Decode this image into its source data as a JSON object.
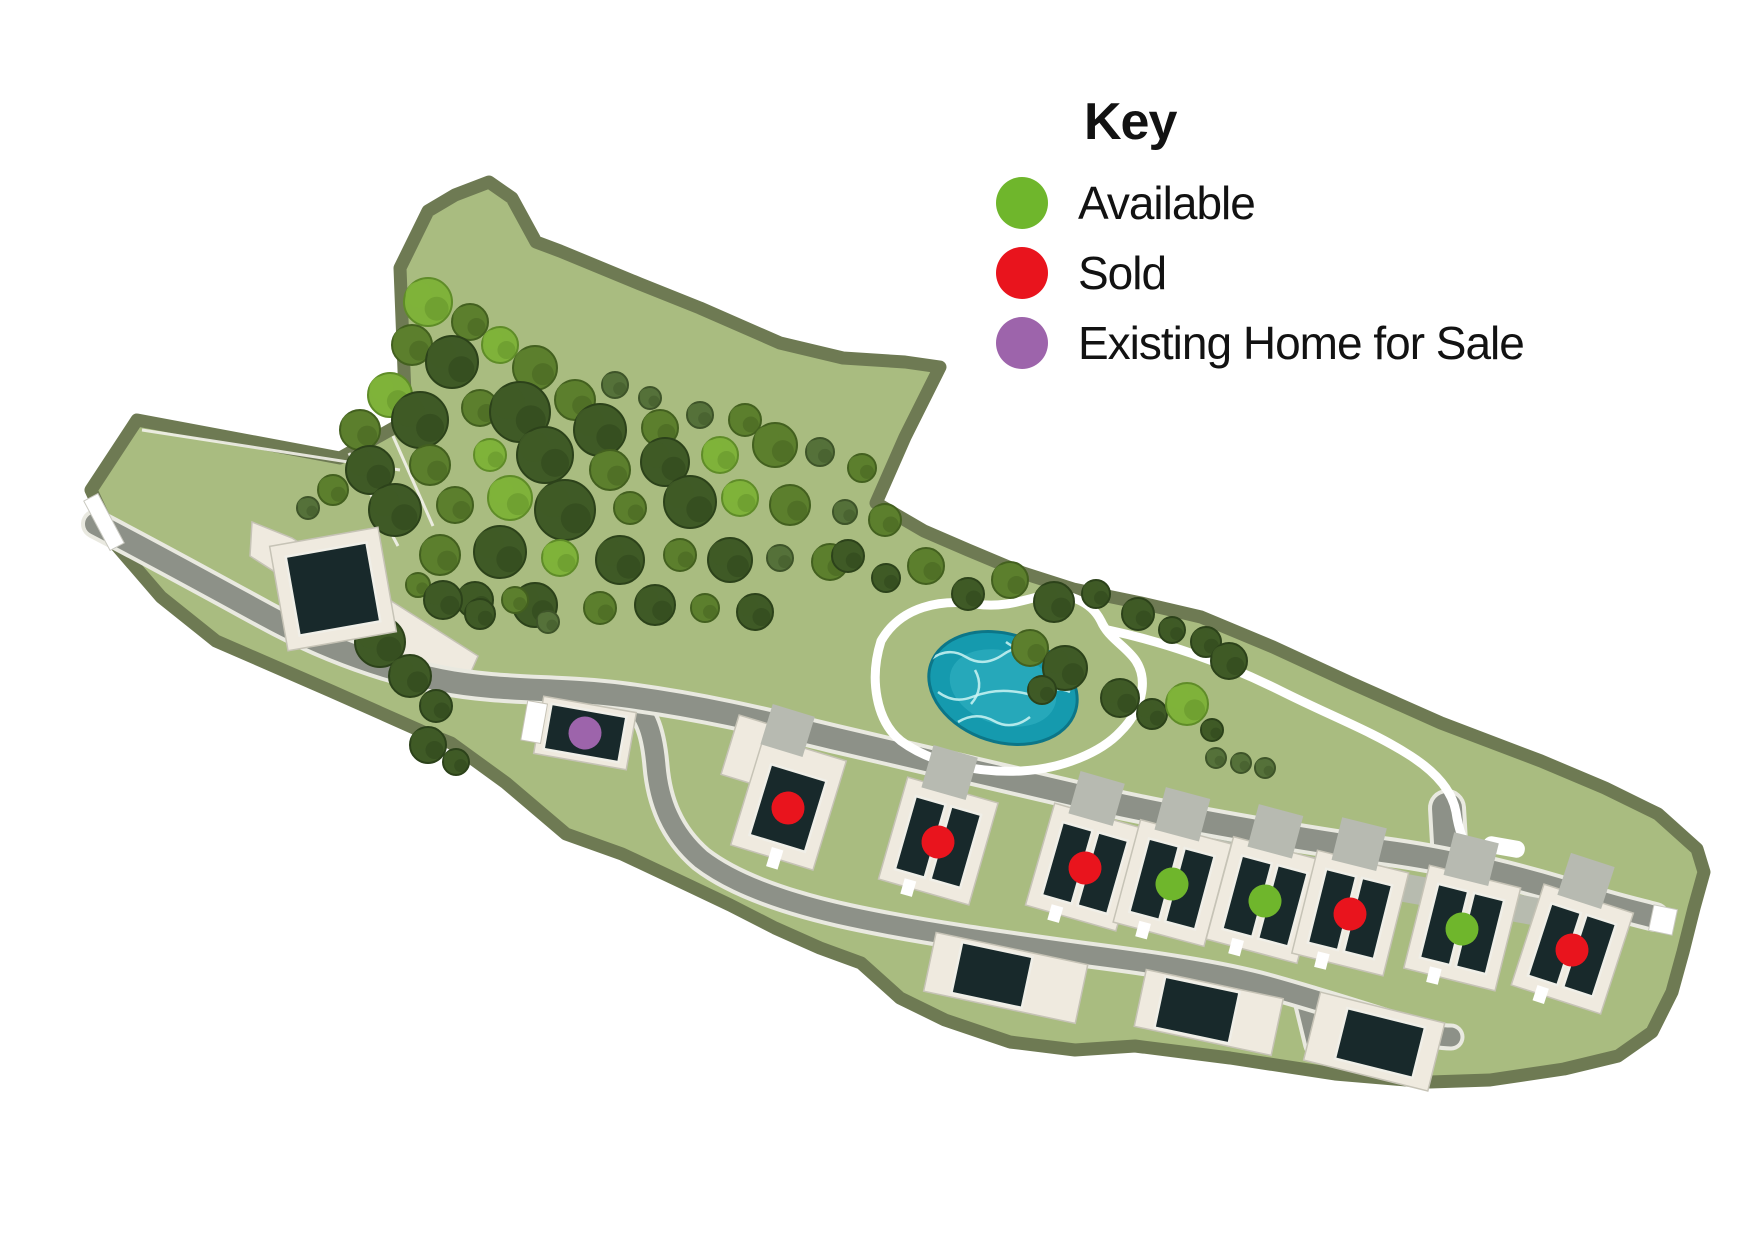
{
  "legend": {
    "title": "Key",
    "items": [
      {
        "label": "Available",
        "color": "#6fb62c",
        "status": "available"
      },
      {
        "label": "Sold",
        "color": "#e9141d",
        "status": "sold"
      },
      {
        "label": "Existing Home for Sale",
        "color": "#9d64ab",
        "status": "existing"
      }
    ]
  },
  "map": {
    "colors": {
      "site": "#a9bc80",
      "border": "#6e7a53",
      "road": "#8d9188",
      "roadEdge": "#e9e9e0",
      "apron": "#b7bab1",
      "pad": "#efeadf",
      "padStroke": "#c6c3b6",
      "building": "#18292b",
      "buildingStroke": "#f0efe8",
      "pathWhite": "#ffffff",
      "pondFill": "#159aae",
      "pondEdge": "#0c7688",
      "pondLight": "#49c4d2",
      "crackle": "#cdf4f3",
      "fieldLine": "#f2f1ea",
      "treeD": "#3f5a26",
      "treeM": "#5c7f2d",
      "treeL": "#7fb23a",
      "treeB": "#55713a",
      "treeStrokeD": "#2c421a",
      "treeStrokeM": "#43601f",
      "treeStrokeL": "#5f8c28",
      "treeStrokeB": "#3e5429"
    },
    "boundary": "M137,420 L340,458 L406,421 L400,268 L428,211 L455,195 L489,182 L512,198 L536,242 L560,251 L640,284 L700,308 L780,343 L843,358 L905,362 L940,367 L905,437 L876,503 L924,531 L968,550 L1023,573 L1073,589 L1141,603 L1201,617 L1273,647 L1351,683 L1441,723 L1541,761 L1605,788 L1658,814 L1697,849 L1704,872 L1694,908 L1683,952 L1672,992 L1652,1032 L1618,1056 L1564,1069 L1490,1080 L1430,1082 L1335,1074 L1230,1058 L1135,1046 L1075,1050 L1010,1042 L945,1020 L900,998 L861,963 L820,948 L775,928 L730,905 L690,886 L622,854 L566,834 L506,783 L451,743 L421,731 L331,691 L216,641 L161,597 L117,546 L91,490 Z",
    "fieldLines": [
      "M142,430 L400,470",
      "M393,436 L433,526",
      "M349,453 L398,546"
    ],
    "creamDrive": "252,522 292,538 478,656 462,692 250,556",
    "band": "1146,826 1560,902 1560,930 1146,856",
    "roads": {
      "hammer": {
        "d": "M1447,808 L1450,860",
        "w": 30
      },
      "stubC": {
        "d": "M1310,1002 L1320,1043",
        "w": 26
      },
      "loop": {
        "d": "M622,696 C646,708 653,731 656,766 C659,801 671,833 701,859 C736,886 791,904 851,917 C921,932 1001,943 1081,954 C1151,963 1221,973 1271,987 C1321,1001 1371,1017 1409,1029 C1429,1035 1443,1037 1451,1037",
        "w": 19
      },
      "main": {
        "d": "M96,524 C150,552 210,585 265,615 C320,645 380,668 440,680 C500,692 560,688 622,696 C700,706 762,721 832,738 C902,755 1002,778 1102,801 C1202,823 1302,839 1382,851 C1452,860 1532,880 1592,900 C1622,909 1640,913 1655,917",
        "w": 22
      }
    },
    "paths": {
      "pondLoop": "M881,641 C901,606 941,599 976,604 C1001,608 1021,601 1041,596 C1066,591 1091,601 1101,621 C1109,639 1126,646 1136,661 C1149,681 1141,711 1121,731 C1101,753 1061,769 1021,771 C976,773 931,763 901,741 C876,721 869,679 881,641 Z",
      "eastPath": "M1108,630 C1160,641 1221,661 1281,691 C1331,716 1371,731 1406,753 C1434,770 1452,790 1456,812 C1459,833 1466,847 1471,858"
    },
    "pill": {
      "x": 1504,
      "y": 847,
      "w": 42,
      "h": 17,
      "rot": 10
    },
    "gates": [
      {
        "x": 104,
        "y": 522,
        "w": 16,
        "h": 56,
        "rot": -28
      },
      {
        "x": 1663,
        "y": 920,
        "w": 24,
        "h": 26,
        "rot": 12
      }
    ],
    "pond": {
      "cx": 1003,
      "cy": 688,
      "rx": 76,
      "ry": 54,
      "rot": 18
    },
    "crackle": [
      "M930,660 q18,-14 36,-3 t38,-3 t36,7",
      "M938,692 q16,12 34,5 t36,-6 t36,8",
      "M958,722 q18,-11 36,-1 t36,-4",
      "M1006,642 q14,11 30,3 t34,-7",
      "M975,670 q10,18 -4,34",
      "M1040,700 q12,-16 30,-8"
    ],
    "trees": [
      [
        428,
        302,
        24,
        "l"
      ],
      [
        470,
        322,
        18,
        "m"
      ],
      [
        412,
        345,
        20,
        "m"
      ],
      [
        452,
        362,
        26,
        "d"
      ],
      [
        500,
        345,
        18,
        "l"
      ],
      [
        535,
        368,
        22,
        "m"
      ],
      [
        390,
        395,
        22,
        "l"
      ],
      [
        360,
        430,
        20,
        "m"
      ],
      [
        420,
        420,
        28,
        "d"
      ],
      [
        480,
        408,
        18,
        "m"
      ],
      [
        520,
        412,
        30,
        "d"
      ],
      [
        575,
        400,
        20,
        "m"
      ],
      [
        615,
        385,
        13,
        "b"
      ],
      [
        650,
        398,
        11,
        "b"
      ],
      [
        600,
        430,
        26,
        "d"
      ],
      [
        660,
        428,
        18,
        "m"
      ],
      [
        700,
        415,
        13,
        "b"
      ],
      [
        745,
        420,
        16,
        "m"
      ],
      [
        370,
        470,
        24,
        "d"
      ],
      [
        430,
        465,
        20,
        "m"
      ],
      [
        490,
        455,
        16,
        "l"
      ],
      [
        545,
        455,
        28,
        "d"
      ],
      [
        610,
        470,
        20,
        "m"
      ],
      [
        665,
        462,
        24,
        "d"
      ],
      [
        720,
        455,
        18,
        "l"
      ],
      [
        775,
        445,
        22,
        "m"
      ],
      [
        820,
        452,
        14,
        "b"
      ],
      [
        862,
        468,
        14,
        "m"
      ],
      [
        395,
        510,
        26,
        "d"
      ],
      [
        455,
        505,
        18,
        "m"
      ],
      [
        510,
        498,
        22,
        "l"
      ],
      [
        565,
        510,
        30,
        "d"
      ],
      [
        630,
        508,
        16,
        "m"
      ],
      [
        690,
        502,
        26,
        "d"
      ],
      [
        740,
        498,
        18,
        "l"
      ],
      [
        790,
        505,
        20,
        "m"
      ],
      [
        845,
        512,
        12,
        "b"
      ],
      [
        885,
        520,
        16,
        "m"
      ],
      [
        440,
        555,
        20,
        "m"
      ],
      [
        500,
        552,
        26,
        "d"
      ],
      [
        560,
        558,
        18,
        "l"
      ],
      [
        620,
        560,
        24,
        "d"
      ],
      [
        680,
        555,
        16,
        "m"
      ],
      [
        730,
        560,
        22,
        "d"
      ],
      [
        780,
        558,
        13,
        "b"
      ],
      [
        830,
        562,
        18,
        "m"
      ],
      [
        475,
        600,
        18,
        "d"
      ],
      [
        535,
        605,
        22,
        "d"
      ],
      [
        600,
        608,
        16,
        "m"
      ],
      [
        655,
        605,
        20,
        "d"
      ],
      [
        705,
        608,
        14,
        "m"
      ],
      [
        755,
        612,
        18,
        "d"
      ],
      [
        848,
        556,
        16,
        "d"
      ],
      [
        886,
        578,
        14,
        "d"
      ],
      [
        926,
        566,
        18,
        "m"
      ],
      [
        968,
        594,
        16,
        "d"
      ],
      [
        1010,
        580,
        18,
        "m"
      ],
      [
        1054,
        602,
        20,
        "d"
      ],
      [
        1096,
        594,
        14,
        "d"
      ],
      [
        1138,
        614,
        16,
        "d"
      ],
      [
        1172,
        630,
        13,
        "d"
      ],
      [
        1206,
        642,
        15,
        "d"
      ],
      [
        1229,
        661,
        18,
        "d"
      ],
      [
        1030,
        648,
        18,
        "m"
      ],
      [
        1065,
        668,
        22,
        "d"
      ],
      [
        1042,
        690,
        14,
        "d"
      ],
      [
        1120,
        698,
        19,
        "d"
      ],
      [
        1152,
        714,
        15,
        "d"
      ],
      [
        1187,
        704,
        21,
        "l"
      ],
      [
        1212,
        730,
        11,
        "d"
      ],
      [
        1216,
        758,
        10,
        "b"
      ],
      [
        1241,
        763,
        10,
        "b"
      ],
      [
        1265,
        768,
        10,
        "b"
      ],
      [
        380,
        642,
        25,
        "d"
      ],
      [
        410,
        676,
        21,
        "d"
      ],
      [
        436,
        706,
        16,
        "d"
      ],
      [
        428,
        745,
        18,
        "d"
      ],
      [
        456,
        762,
        13,
        "d"
      ],
      [
        333,
        490,
        15,
        "m"
      ],
      [
        308,
        508,
        11,
        "b"
      ],
      [
        418,
        585,
        12,
        "m"
      ],
      [
        443,
        600,
        19,
        "d"
      ],
      [
        480,
        614,
        15,
        "d"
      ],
      [
        515,
        600,
        13,
        "m"
      ],
      [
        548,
        622,
        11,
        "b"
      ]
    ],
    "plots": [
      {
        "status": "sold",
        "x": 788,
        "y": 808,
        "rot": 17,
        "kind": "single"
      },
      {
        "status": "sold",
        "x": 938,
        "y": 842,
        "rot": 16,
        "kind": "pair"
      },
      {
        "status": "sold",
        "x": 1085,
        "y": 868,
        "rot": 16,
        "kind": "pair"
      },
      {
        "status": "available",
        "x": 1172,
        "y": 884,
        "rot": 15,
        "kind": "pair"
      },
      {
        "status": "available",
        "x": 1265,
        "y": 901,
        "rot": 15,
        "kind": "pair"
      },
      {
        "status": "sold",
        "x": 1350,
        "y": 914,
        "rot": 14,
        "kind": "pair"
      },
      {
        "status": "available",
        "x": 1462,
        "y": 929,
        "rot": 14,
        "kind": "pair"
      },
      {
        "status": "sold",
        "x": 1572,
        "y": 950,
        "rot": 18,
        "kind": "pair"
      },
      {
        "status": "existing",
        "x": 585,
        "y": 733,
        "rot": 10,
        "kind": "wide"
      }
    ],
    "buildings": [
      {
        "x": 333,
        "y": 589,
        "rot": -10,
        "w": 82,
        "h": 80,
        "padW": 110,
        "padH": 106
      },
      {
        "x": 992,
        "y": 975,
        "rot": 12,
        "w": 72,
        "h": 52,
        "padW": 155,
        "padH": 60,
        "padDx": 14
      },
      {
        "x": 1197,
        "y": 1010,
        "rot": 12,
        "w": 76,
        "h": 52,
        "padW": 140,
        "padH": 58,
        "padDx": 12
      },
      {
        "x": 1380,
        "y": 1043,
        "rot": 14,
        "w": 80,
        "h": 52,
        "padW": 128,
        "padH": 70,
        "padDx": -6
      }
    ],
    "extraPads": [
      {
        "x": 754,
        "y": 752,
        "w": 50,
        "h": 62,
        "rot": 17
      }
    ],
    "dotRadius": 16.5
  }
}
